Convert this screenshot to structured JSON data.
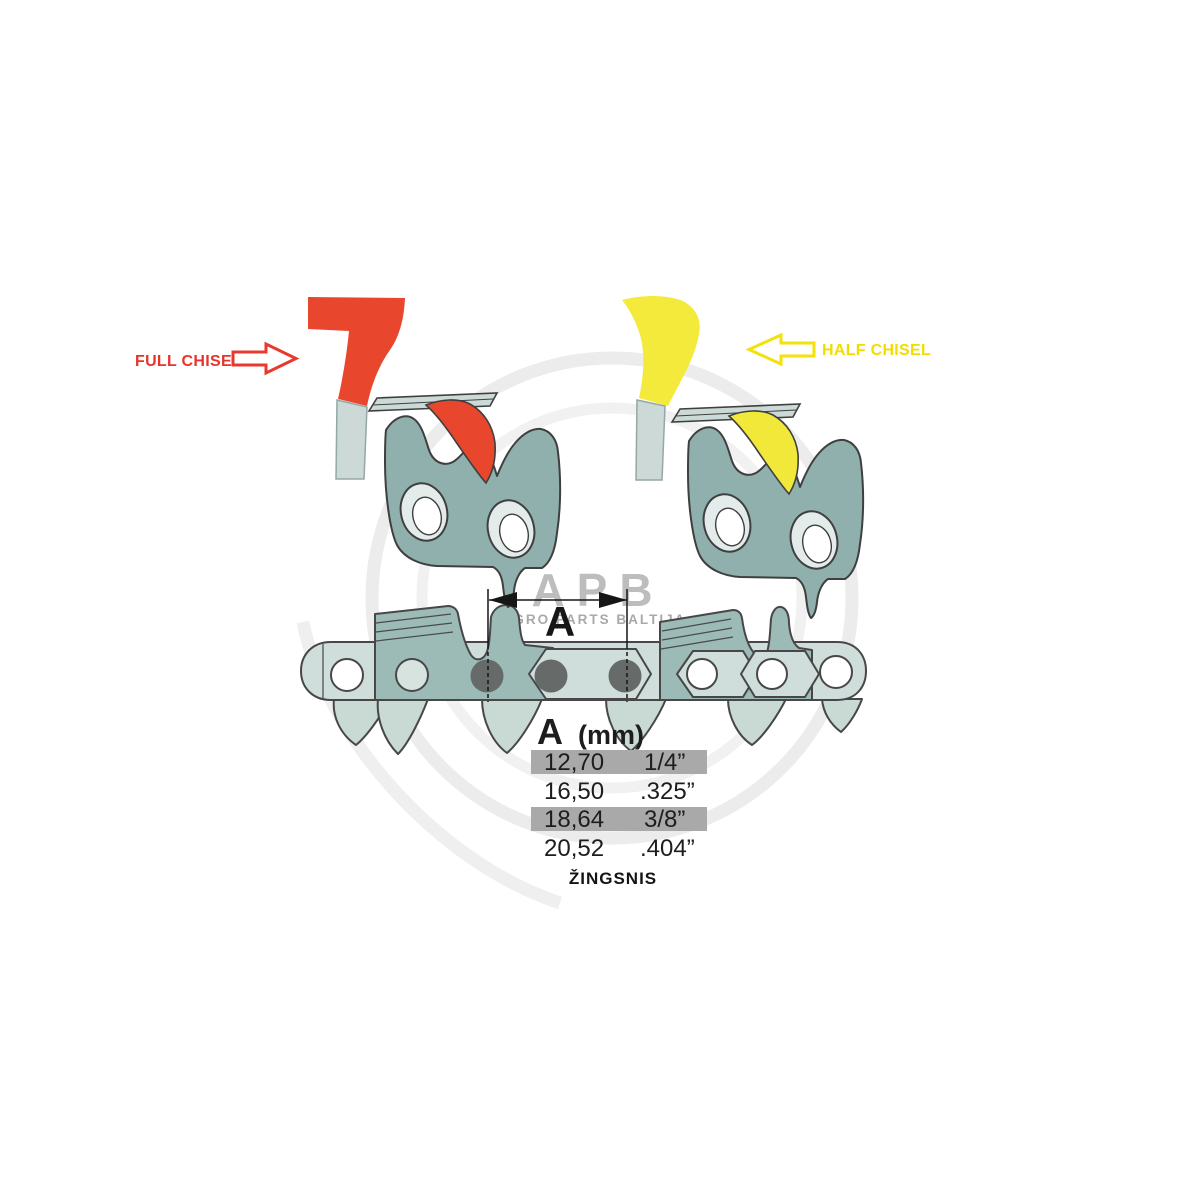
{
  "annotations": {
    "full_chisel_label": "FULL CHISEL",
    "half_chisel_label": "HALF CHISEL"
  },
  "dimension": {
    "label": "A"
  },
  "pitch_table": {
    "header_letter": "A",
    "header_unit": "(mm)",
    "rows": [
      {
        "mm": "12,70",
        "inches": "1/4”",
        "highlighted": true
      },
      {
        "mm": "16,50",
        "inches": ".325”",
        "highlighted": false
      },
      {
        "mm": "18,64",
        "inches": "3/8”",
        "highlighted": true
      },
      {
        "mm": "20,52",
        "inches": ".404”",
        "highlighted": false
      }
    ],
    "caption": "ŽINGSNIS"
  },
  "watermark": {
    "acronym": "APB",
    "name": "AGRO PARTS BALTIJA"
  },
  "colors": {
    "full_chisel_red": "#e8472e",
    "half_chisel_yellow": "#f4ea3c",
    "link_body_teal": "#8fb0ac",
    "link_plate_light": "#ccdad7",
    "chain_band": "#cfdeda",
    "chain_cutter": "#9cbab6",
    "rivet_dark": "#666b6a",
    "table_highlight_gray": "#a9a9a9",
    "watermark_gray": "#bdbdbd"
  }
}
